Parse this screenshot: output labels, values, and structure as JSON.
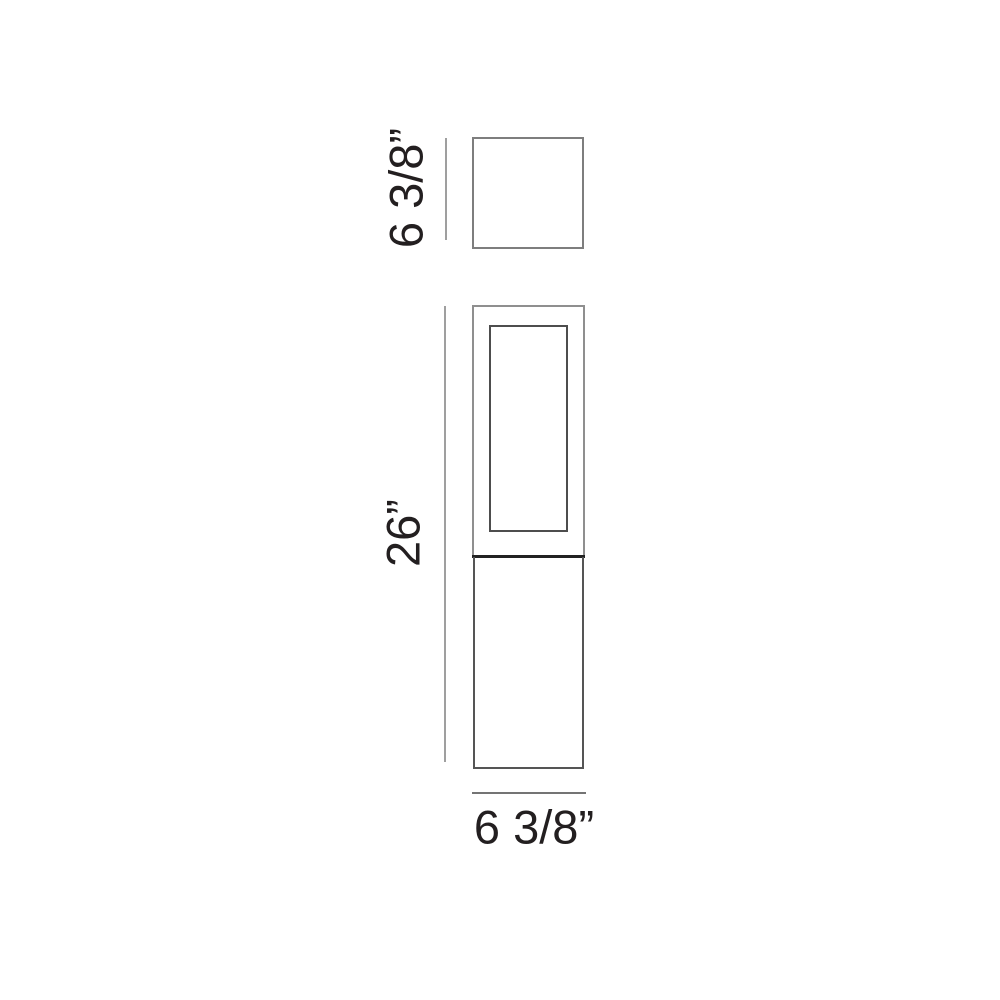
{
  "diagram": {
    "type": "product-dimension-drawing",
    "views": [
      {
        "id": "top-view",
        "description": "square outline (fixture seen from above)"
      },
      {
        "id": "front-view",
        "description": "tall fixture with framed window panel over solid lower body"
      }
    ],
    "dimensions": [
      {
        "id": "top-depth",
        "label": "6 3/8”",
        "orientation": "vertical-rotated",
        "applies_to": "top-view square side"
      },
      {
        "id": "overall-height",
        "label": "26”",
        "orientation": "vertical-rotated",
        "applies_to": "front-view overall height"
      },
      {
        "id": "overall-width",
        "label": "6 3/8”",
        "orientation": "horizontal",
        "applies_to": "front-view overall width"
      }
    ],
    "colors": {
      "background": "#ffffff",
      "text": "#231f20",
      "line_light": "#9f9f9f",
      "line_medium": "#7e7e7e",
      "line_dark": "#4d4d4d",
      "divider": "#222222"
    }
  }
}
